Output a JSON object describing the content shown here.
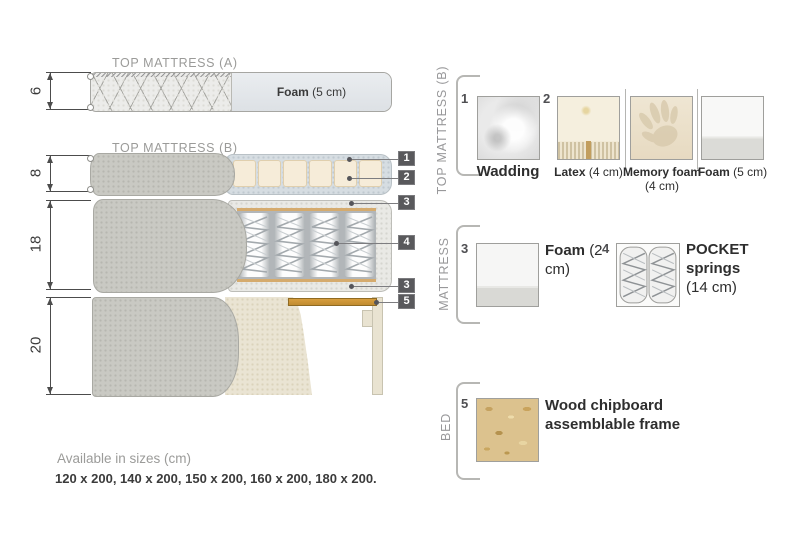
{
  "diagram": {
    "top_a_title": "TOP MATTRESS (A)",
    "top_b_title": "TOP MATTRESS (B)",
    "dims": {
      "top_a": "6",
      "top_b": "8",
      "mattress": "18",
      "bed": "20"
    },
    "foam_label": {
      "name": "Foam",
      "size": "(5 cm)"
    },
    "callouts": {
      "c1": "1",
      "c2": "2",
      "c3_top": "3",
      "c4": "4",
      "c3_bottom": "3",
      "c5": "5"
    }
  },
  "legend": {
    "top_b": {
      "title": "TOP MATTRESS (B)",
      "wadding": {
        "num": "1",
        "name": "Wadding"
      },
      "latex": {
        "num": "2",
        "name": "Latex",
        "size": "(4 cm)"
      },
      "memory_foam": {
        "name": "Memory foam",
        "size": "(4 cm)"
      },
      "foam": {
        "name": "Foam",
        "size": "(5 cm)"
      }
    },
    "mattress": {
      "title": "MATTRESS",
      "foam": {
        "num": "3",
        "name": "Foam",
        "size": "(2 cm)"
      },
      "pocket_springs": {
        "num": "4",
        "name": "POCKET springs",
        "size": "(14 cm)"
      }
    },
    "bed": {
      "title": "BED",
      "frame": {
        "num": "5",
        "name": "Wood chipboard assemblable frame"
      }
    }
  },
  "footer": {
    "available": "Available in sizes (cm)",
    "sizes": "120 x 200, 140 x 200, 150 x 200, 160 x 200, 180 x 200."
  },
  "colors": {
    "wood": "#c8923a",
    "callout_tag": "#59595c",
    "cover_grey": "#c9c9c3",
    "latex": "#f6ecd9",
    "wadding_cutaway": "#d6dde2",
    "chipboard": "#dcc28e",
    "muted_text": "#9b9b99",
    "dark_text": "#3a3a3a"
  }
}
